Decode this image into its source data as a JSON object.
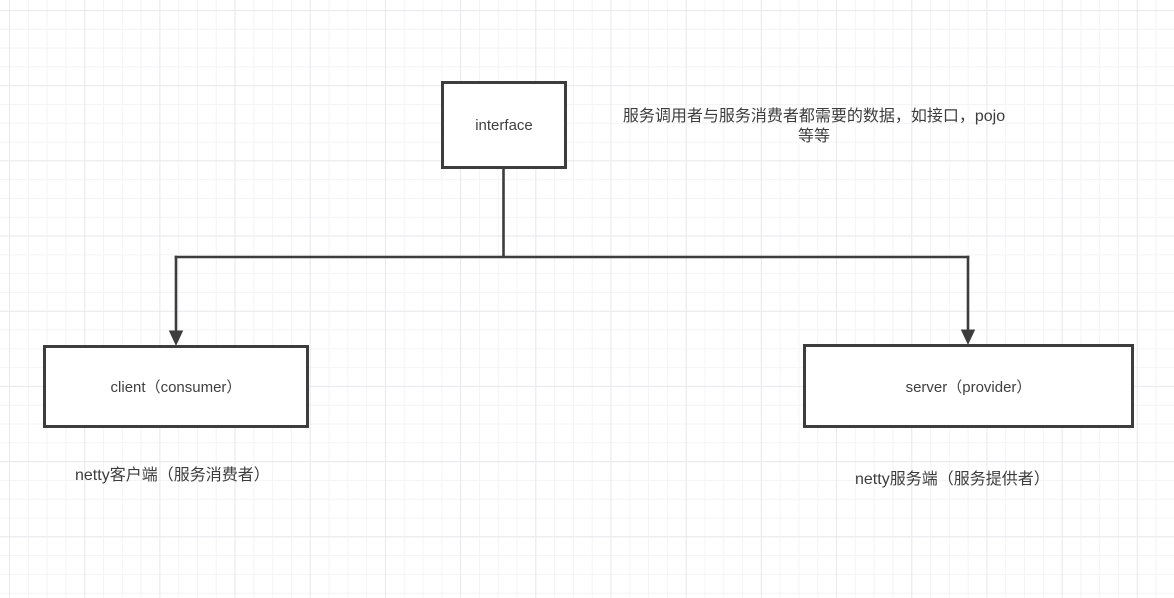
{
  "canvas": {
    "background": "#ffffff",
    "grid_minor_color": "#f4f4f6",
    "grid_major_color": "#e9e9ed"
  },
  "style": {
    "stroke_color": "#3d3d3d",
    "text_color": "#3d3d3d"
  },
  "nodes": {
    "interface": {
      "label": "interface"
    },
    "client": {
      "label": "client（consumer）"
    },
    "server": {
      "label": "server（provider）"
    }
  },
  "edges": [
    {
      "from": "interface",
      "to": "client",
      "arrow_end": "down"
    },
    {
      "from": "interface",
      "to": "server",
      "arrow_end": "down"
    }
  ],
  "notes": {
    "interface_note": {
      "line1": "服务调用者与服务消费者都需要的数据，如接口，pojo",
      "line2": "等等"
    },
    "client_note": "netty客户端（服务消费者）",
    "server_note": "netty服务端（服务提供者）"
  }
}
